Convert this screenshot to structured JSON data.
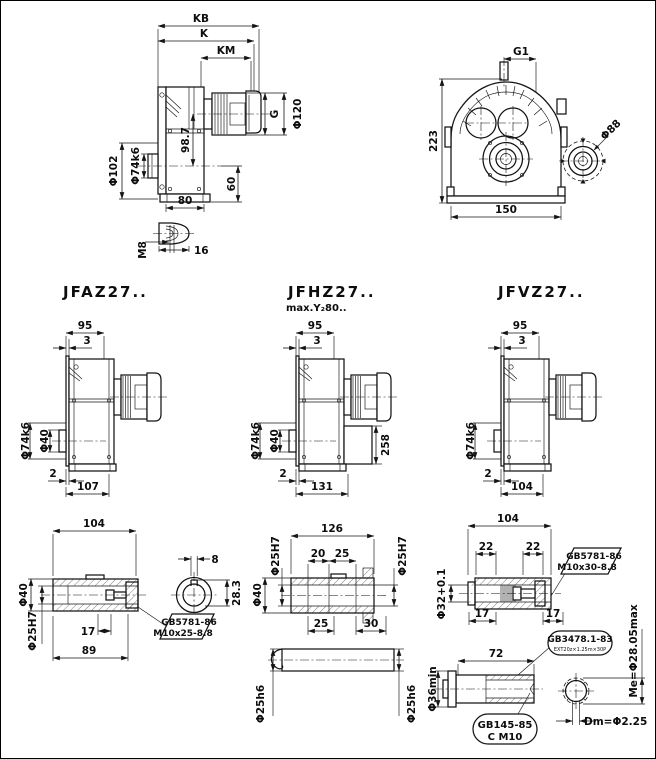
{
  "page": {
    "bg": "#ffffff",
    "ink": "#141414"
  },
  "side_view": {
    "kb": "KB",
    "k": "K",
    "km": "KM",
    "g": "G",
    "d120": "Φ120",
    "d102": "Φ102",
    "d74": "Φ74k6",
    "h98": "98.7",
    "h60": "60",
    "w80": "80",
    "thread": "M8",
    "key_len": "16"
  },
  "front_view": {
    "g1": "G1",
    "h223": "223",
    "w150": "150",
    "flange": "Φ88"
  },
  "variants": [
    {
      "title": "JFAZ27..",
      "subtitle": "",
      "w95": "95",
      "t3": "3",
      "d74": "Φ74k6",
      "d40": "Φ40",
      "gap2": "2",
      "width": "107",
      "ext": ""
    },
    {
      "title": "JFHZ27..",
      "subtitle": "max.Y₂80..",
      "w95": "95",
      "t3": "3",
      "d74": "Φ74k6",
      "d40": "Φ40",
      "gap2": "2",
      "width": "131",
      "ext": "258"
    },
    {
      "title": "JFVZ27..",
      "subtitle": "",
      "w95": "95",
      "t3": "3",
      "d74": "Φ74k6",
      "d40": "",
      "gap2": "2",
      "width": "104",
      "ext": ""
    }
  ],
  "hollow_shaft": {
    "len": "104",
    "d40": "Φ40",
    "d25": "Φ25H7",
    "l17": "17",
    "l89": "89",
    "key_w": "8",
    "key_d": "28.3",
    "note1": "GB5781-86",
    "note2": "M10x25-8.8"
  },
  "through_shaft": {
    "len": "126",
    "l20": "20",
    "l25": "25",
    "d25_left": "Φ25H7",
    "d25_right": "Φ25H7",
    "d40": "Φ40",
    "l25b": "25",
    "l30": "30",
    "d25_shaft_left": "Φ25h6",
    "d25_shaft_right": "Φ25h6"
  },
  "spline_shaft": {
    "len": "104",
    "l22a": "22",
    "l22b": "22",
    "d32": "Φ32+0.1",
    "l17a": "17",
    "l17b": "17",
    "note1": "GB5781-86",
    "note2": "M10x30-8.8",
    "len72": "72",
    "spline_std": "GB3478.1-83",
    "spline_spec": "EXT20z×1.25m×30P",
    "d36": "Φ36min",
    "me": "Me=Φ28.05max",
    "center_std": "GB145-85",
    "center_type": "C M10",
    "dm": "Dm=Φ2.25"
  }
}
